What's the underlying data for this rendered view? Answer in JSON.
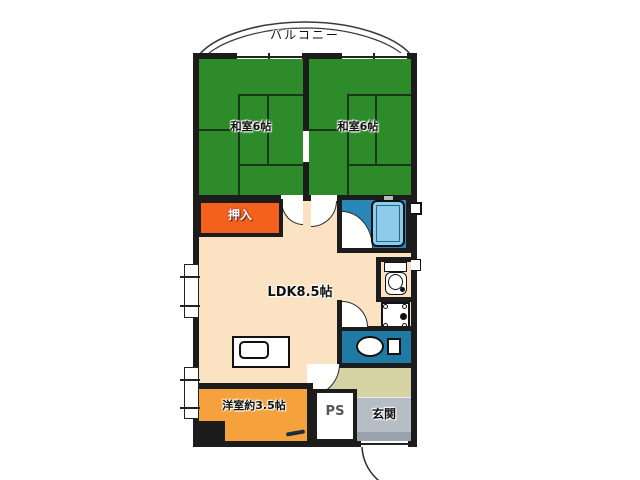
{
  "balcony": {
    "label": "バルコニー"
  },
  "rooms": {
    "washitsu_left": {
      "label": "和室6帖"
    },
    "washitsu_right": {
      "label": "和室6帖"
    },
    "oshiire": {
      "label": "押入"
    },
    "ldk": {
      "label": "LDK8.5帖"
    },
    "youshitsu": {
      "label": "洋室約3.5帖"
    },
    "ps": {
      "label": "PS"
    },
    "genkan": {
      "label": "玄関"
    }
  },
  "fixtures": {
    "bathtub": "bathtub",
    "toilet": "toilet",
    "washbasin": "washbasin",
    "kitchen_sink": "kitchen-sink",
    "washing_machine_pan": "washing-machine-pan"
  },
  "colors": {
    "wall": "#1c1c1c",
    "tatami-green": "#2e8b2a",
    "oshiire-orange": "#f4611c",
    "youshitsu-orange": "#f6a23c",
    "ldk-peach": "#fbe2c2",
    "bath-blue": "#2a86b8",
    "tub-blue": "#8ecbea",
    "washroom-teal": "#1f7ba6",
    "hall-khaki": "#d5d2a4",
    "genkan-gray": "#b6bdc4"
  }
}
